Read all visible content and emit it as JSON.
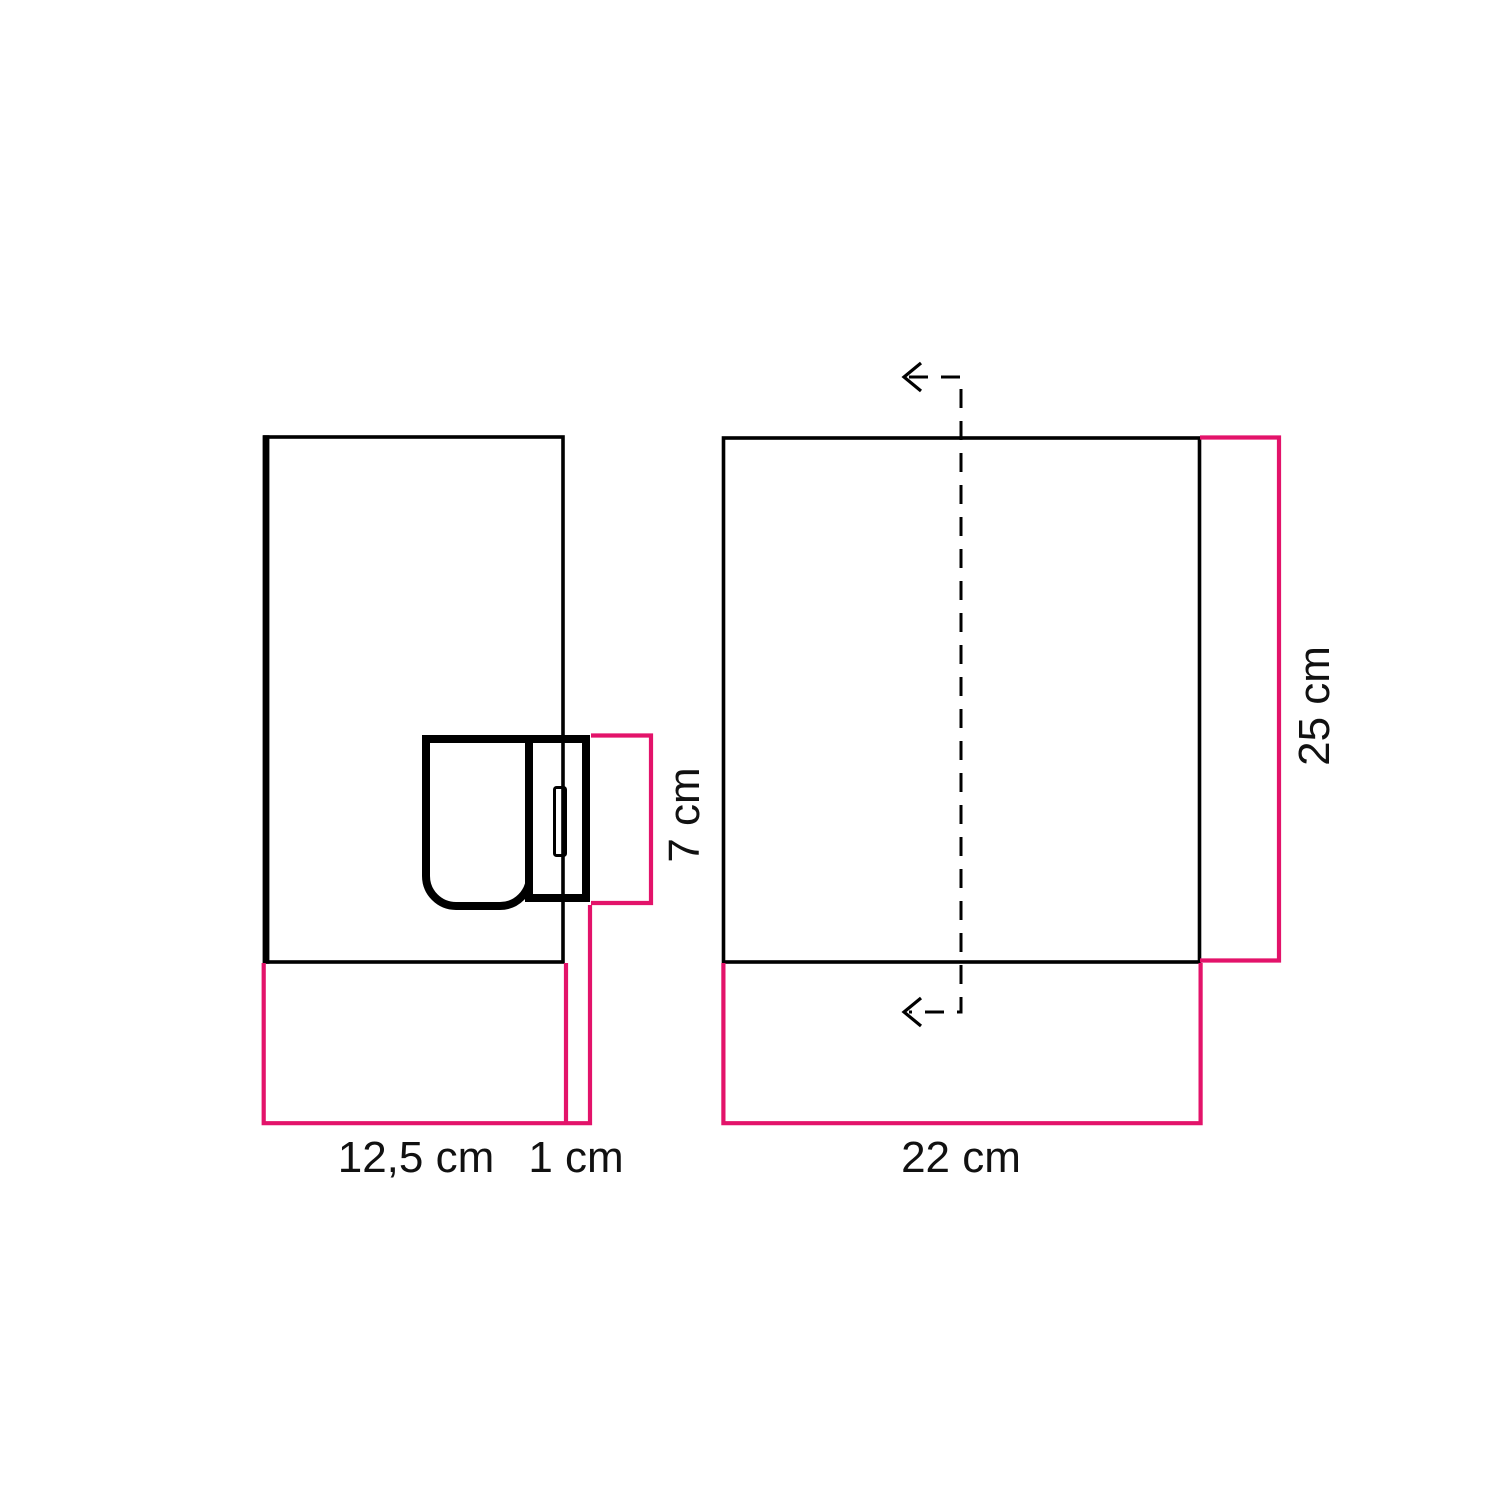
{
  "colors": {
    "background": "#ffffff",
    "outline_black": "#000000",
    "dimension_pink": "#e3136a",
    "label_text": "#111111"
  },
  "side_view": {
    "width_label": "12,5 cm",
    "gap_label": "1 cm",
    "socket_height_label": "7 cm"
  },
  "front_view": {
    "width_label": "22 cm",
    "height_label": "25 cm"
  },
  "dimensions_cm": {
    "side_width": 12.5,
    "gap": 1,
    "socket_height": 7,
    "front_width": 22,
    "front_height": 25
  }
}
